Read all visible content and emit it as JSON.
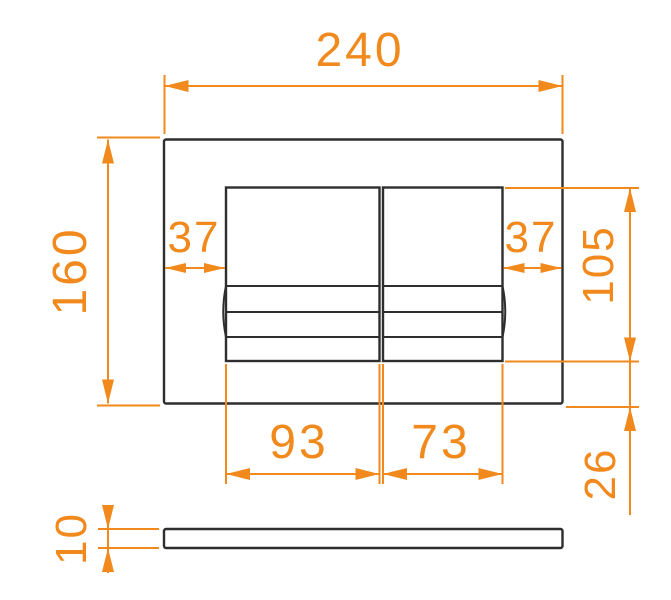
{
  "meta": {
    "type": "technical-dimension-drawing",
    "subject": "dual-flush wall plate, front view and side profile"
  },
  "colors": {
    "dimension_accent": "#f2891c",
    "part_outline": "#2e2e2e",
    "background": "#ffffff"
  },
  "dimensions": {
    "plate_width": "240",
    "plate_height": "160",
    "button_inset_left": "37",
    "button_inset_right": "37",
    "buttons_height": "105",
    "large_button_width": "93",
    "small_button_width": "73",
    "buttons_bottom_offset": "26",
    "plate_thickness": "10"
  }
}
